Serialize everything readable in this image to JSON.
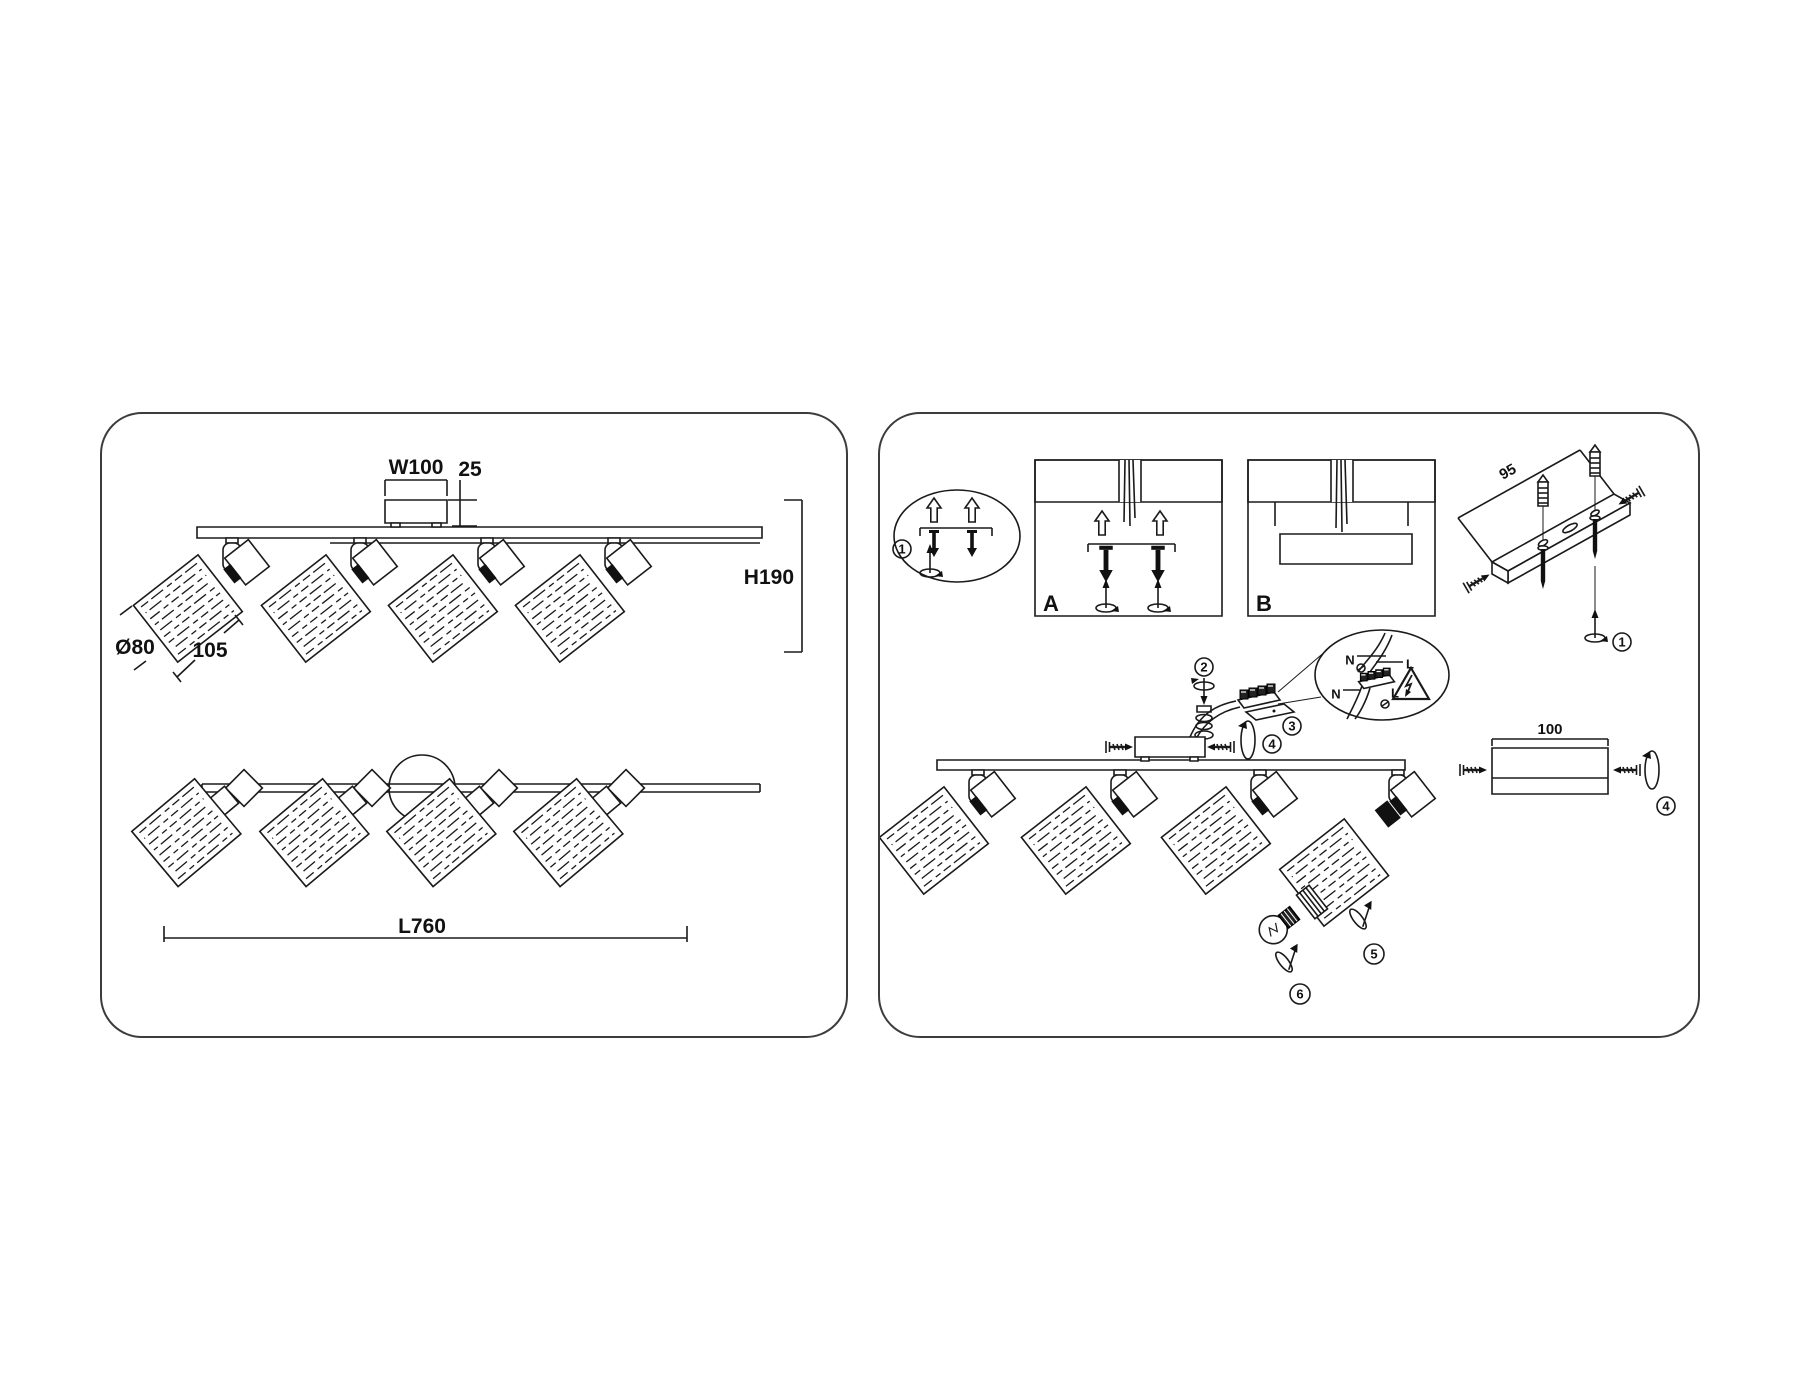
{
  "left_panel": {
    "dims": {
      "canopy_width": "W100",
      "canopy_height": "25",
      "height": "H190",
      "shade_diameter": "Ø80",
      "shade_length": "105",
      "length": "L760"
    }
  },
  "right_panel": {
    "steps": {
      "one": "1",
      "two": "2",
      "three": "3",
      "four": "4",
      "five": "5",
      "six": "6"
    },
    "options": {
      "a": "A",
      "b": "B"
    },
    "dims": {
      "bracket_spacing": "95",
      "canopy_length": "100"
    },
    "wiring": {
      "neutral": "N",
      "live": "L"
    }
  }
}
